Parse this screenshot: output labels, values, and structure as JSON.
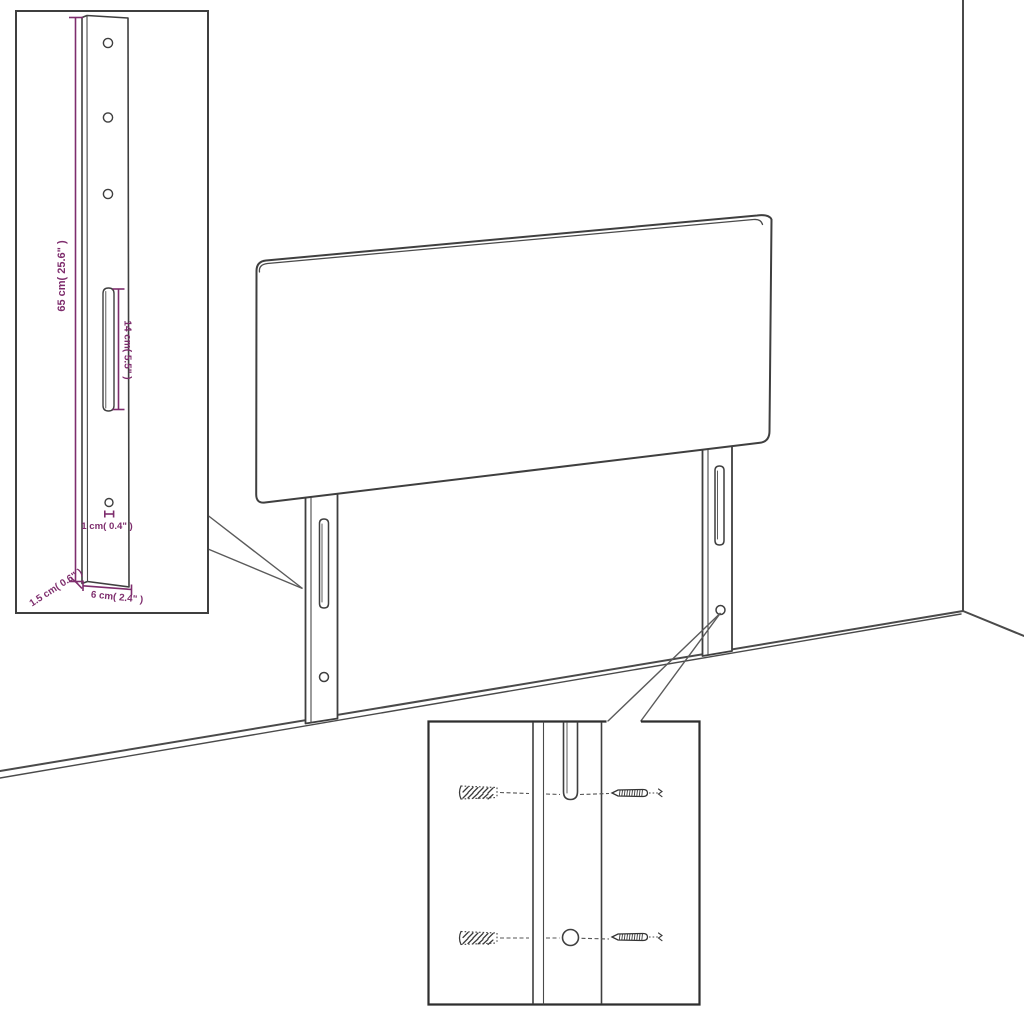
{
  "diagram": {
    "title": "headboard-assembly-diagram",
    "colors": {
      "line": "#3f3f3f",
      "dimension_accent": "#7e2d6d",
      "inset_border": "#2e2e2e",
      "background": "#ffffff"
    },
    "leg_dimension_inset": {
      "labels": {
        "height": "65 cm( 25.6\" )",
        "slot": "14 cm( 5.5\" )",
        "hole": "1 cm( 0.4\" )",
        "depth": "1.5 cm( 0.6\" )",
        "width": "6 cm( 2.4\" )"
      }
    },
    "hardware_inset": {
      "parts": [
        "wall-plug",
        "screw"
      ]
    }
  }
}
